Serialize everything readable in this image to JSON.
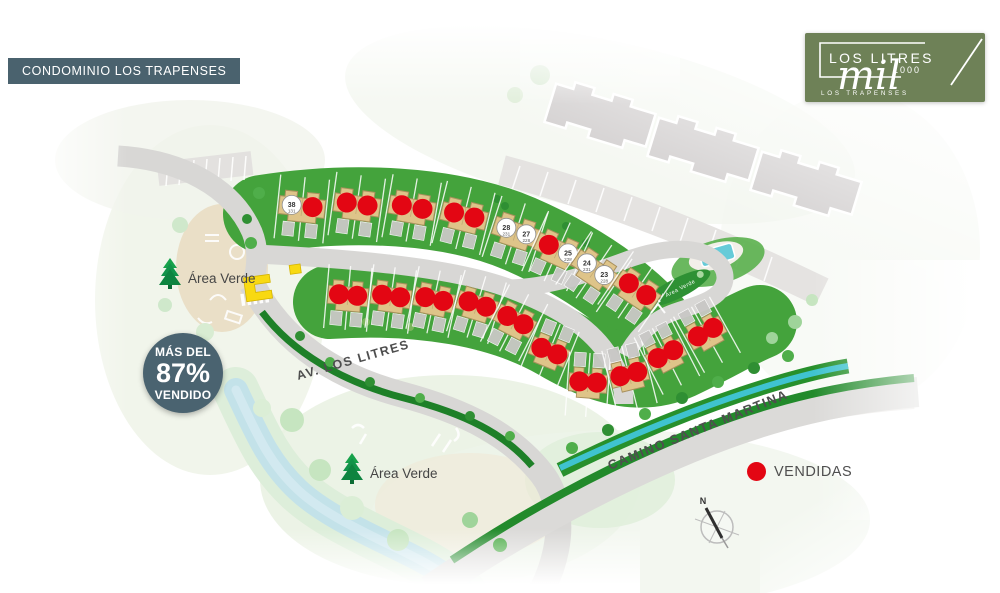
{
  "header": {
    "title": "CONDOMINIO LOS TRAPENSES"
  },
  "logo": {
    "brand_top": "LOS LITRES",
    "brand_number": "1000",
    "brand_script": "mil",
    "brand_bottom": "LOS TRAPENSES"
  },
  "badge": {
    "line1": "MÁS DEL",
    "percent": "87%",
    "line2": "VENDIDO"
  },
  "legend": {
    "label": "VENDIDAS",
    "dot_color": "#e30613"
  },
  "labels": {
    "area_verde_1": "Área Verde",
    "area_verde_2": "Área Verde",
    "area_verde_island": "Área Verde",
    "street_av": "AV.  LOS LITRES",
    "street_camino": "CAMINO SANTA MARTINA",
    "compass_n": "N"
  },
  "colors": {
    "slate": "#4a6370",
    "logo_green": "#6e8157",
    "sold_red": "#e30613",
    "grass": "#44a33c",
    "road": "#d8d7d5",
    "house_tan": "#dec489",
    "stream": "#3fc3cf"
  },
  "map": {
    "houses": [
      {
        "x": 302,
        "y": 207,
        "rot": 6,
        "units": [
          {
            "n": "38",
            "s": "131"
          },
          "d"
        ]
      },
      {
        "x": 357,
        "y": 205,
        "rot": 8,
        "units": [
          "d",
          "d"
        ]
      },
      {
        "x": 412,
        "y": 208,
        "rot": 10,
        "units": [
          "d",
          "d"
        ]
      },
      {
        "x": 464,
        "y": 216,
        "rot": 14,
        "units": [
          "d",
          "d"
        ]
      },
      {
        "x": 516,
        "y": 232,
        "rot": 18,
        "units": [
          {
            "n": "28",
            "s": "231"
          },
          {
            "n": "27",
            "s": "228"
          }
        ]
      },
      {
        "x": 558,
        "y": 250,
        "rot": 24,
        "units": [
          "d",
          {
            "n": "25",
            "s": "228"
          }
        ]
      },
      {
        "x": 595,
        "y": 270,
        "rot": 34,
        "units": [
          {
            "n": "24",
            "s": "231"
          },
          {
            "n": "23",
            "s": "228"
          }
        ]
      },
      {
        "x": 637,
        "y": 290,
        "rot": 34,
        "units": [
          "d",
          "d"
        ]
      },
      {
        "x": 348,
        "y": 296,
        "rot": 5,
        "w": 40,
        "units": [
          "d",
          "d"
        ]
      },
      {
        "x": 391,
        "y": 297,
        "rot": 8,
        "w": 40,
        "units": [
          "d",
          "d"
        ]
      },
      {
        "x": 434,
        "y": 300,
        "rot": 12,
        "w": 40,
        "units": [
          "d",
          "d"
        ]
      },
      {
        "x": 477,
        "y": 305,
        "rot": 17,
        "w": 40,
        "units": [
          "d",
          "d"
        ]
      },
      {
        "x": 515,
        "y": 321,
        "rot": 27,
        "w": 40,
        "units": [
          "d",
          "d"
        ]
      },
      {
        "x": 549,
        "y": 352,
        "rot": 22,
        "w": 38,
        "drv": "top",
        "units": [
          "d",
          "d"
        ]
      },
      {
        "x": 588,
        "y": 383,
        "rot": 4,
        "w": 38,
        "drv": "top",
        "units": [
          "d",
          "d"
        ]
      },
      {
        "x": 629,
        "y": 375,
        "rot": -14,
        "w": 38,
        "drv": "top",
        "units": [
          "d",
          "d"
        ]
      },
      {
        "x": 666,
        "y": 355,
        "rot": -27,
        "w": 38,
        "drv": "top",
        "units": [
          "d",
          "d"
        ]
      },
      {
        "x": 706,
        "y": 333,
        "rot": -29,
        "w": 38,
        "drv": "top",
        "units": [
          "d",
          "d"
        ]
      }
    ]
  }
}
